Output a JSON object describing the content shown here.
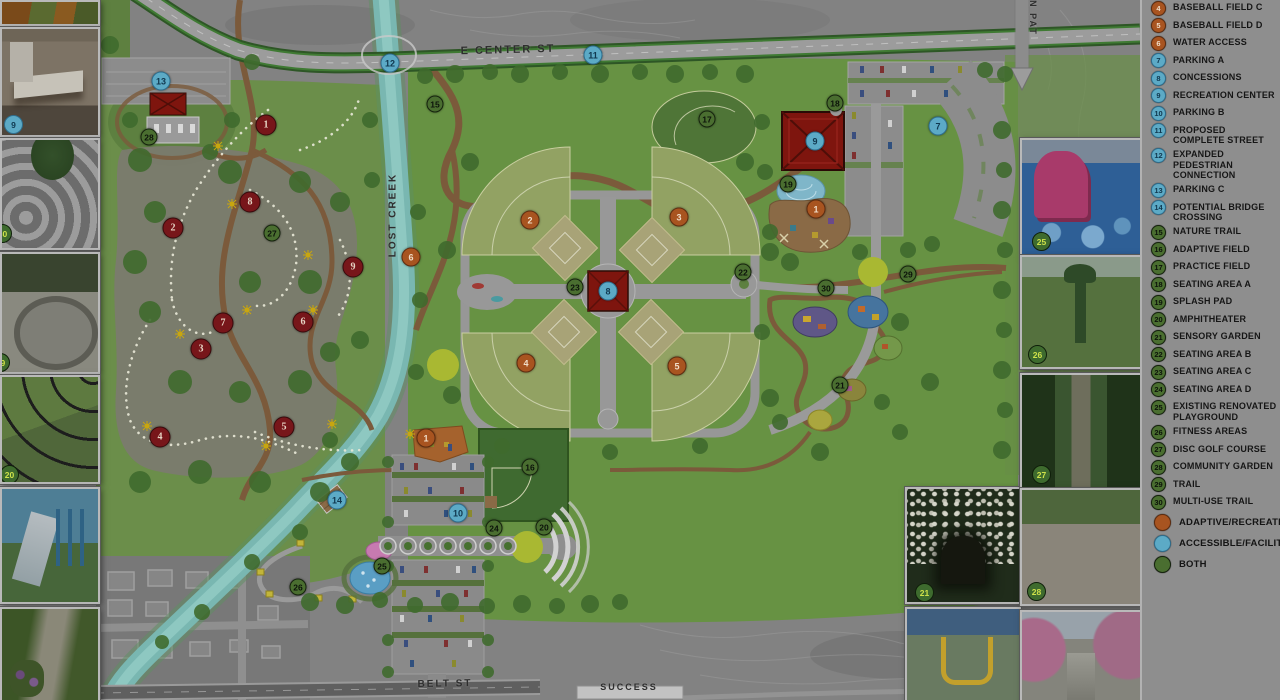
{
  "title": "park-master-plan",
  "map": {
    "street_labels": [
      {
        "text": "E CENTER ST",
        "x": 508,
        "y": 50,
        "rot": -1.5,
        "size": 11
      },
      {
        "text": "LOST CREEK",
        "x": 393,
        "y": 215,
        "rot": -90,
        "size": 10
      },
      {
        "text": "N PAT",
        "x": 1033,
        "y": 18,
        "rot": 90,
        "size": 9
      },
      {
        "text": "BELT ST",
        "x": 445,
        "y": 684,
        "rot": -1,
        "size": 10
      },
      {
        "text": "SUCCESS",
        "x": 629,
        "y": 687,
        "rot": 0,
        "size": 9
      }
    ],
    "markers": [
      {
        "n": "1",
        "t": "o",
        "x": 816,
        "y": 209
      },
      {
        "n": "1",
        "t": "o",
        "x": 426,
        "y": 438
      },
      {
        "n": "2",
        "t": "o",
        "x": 530,
        "y": 220
      },
      {
        "n": "3",
        "t": "o",
        "x": 679,
        "y": 217
      },
      {
        "n": "4",
        "t": "o",
        "x": 526,
        "y": 363
      },
      {
        "n": "5",
        "t": "o",
        "x": 677,
        "y": 366
      },
      {
        "n": "6",
        "t": "o",
        "x": 411,
        "y": 257
      },
      {
        "n": "7",
        "t": "b",
        "x": 938,
        "y": 126
      },
      {
        "n": "8",
        "t": "b",
        "x": 608,
        "y": 291
      },
      {
        "n": "9",
        "t": "b",
        "x": 815,
        "y": 141
      },
      {
        "n": "10",
        "t": "b",
        "x": 458,
        "y": 513
      },
      {
        "n": "11",
        "t": "b",
        "x": 593,
        "y": 55
      },
      {
        "n": "12",
        "t": "b",
        "x": 390,
        "y": 63
      },
      {
        "n": "13",
        "t": "b",
        "x": 161,
        "y": 81
      },
      {
        "n": "14",
        "t": "b",
        "x": 337,
        "y": 500
      },
      {
        "n": "15",
        "t": "g",
        "x": 435,
        "y": 104
      },
      {
        "n": "16",
        "t": "g",
        "x": 530,
        "y": 467
      },
      {
        "n": "17",
        "t": "g",
        "x": 707,
        "y": 119
      },
      {
        "n": "18",
        "t": "g",
        "x": 835,
        "y": 103
      },
      {
        "n": "19",
        "t": "g",
        "x": 788,
        "y": 184
      },
      {
        "n": "20",
        "t": "g",
        "x": 544,
        "y": 527
      },
      {
        "n": "21",
        "t": "g",
        "x": 840,
        "y": 385
      },
      {
        "n": "22",
        "t": "g",
        "x": 743,
        "y": 272
      },
      {
        "n": "23",
        "t": "g",
        "x": 575,
        "y": 287
      },
      {
        "n": "24",
        "t": "g",
        "x": 494,
        "y": 528
      },
      {
        "n": "25",
        "t": "g",
        "x": 382,
        "y": 566
      },
      {
        "n": "26",
        "t": "g",
        "x": 298,
        "y": 587
      },
      {
        "n": "27",
        "t": "g",
        "x": 272,
        "y": 233
      },
      {
        "n": "28",
        "t": "g",
        "x": 149,
        "y": 137
      },
      {
        "n": "29",
        "t": "g",
        "x": 908,
        "y": 274
      },
      {
        "n": "30",
        "t": "g",
        "x": 826,
        "y": 288
      },
      {
        "n": "1",
        "t": "h",
        "x": 266,
        "y": 125
      },
      {
        "n": "2",
        "t": "h",
        "x": 173,
        "y": 228
      },
      {
        "n": "3",
        "t": "h",
        "x": 201,
        "y": 349
      },
      {
        "n": "4",
        "t": "h",
        "x": 160,
        "y": 437
      },
      {
        "n": "5",
        "t": "h",
        "x": 284,
        "y": 427
      },
      {
        "n": "6",
        "t": "h",
        "x": 303,
        "y": 322
      },
      {
        "n": "7",
        "t": "h",
        "x": 223,
        "y": 323
      },
      {
        "n": "8",
        "t": "h",
        "x": 250,
        "y": 202
      },
      {
        "n": "9",
        "t": "h",
        "x": 353,
        "y": 267
      }
    ]
  },
  "photos": [
    {
      "kind": "play-closeup",
      "name": "photo-playground-closeup",
      "x": 0,
      "y": 0,
      "w": 96,
      "h": 22
    },
    {
      "kind": "changing-room",
      "name": "photo-adult-changing-room",
      "x": 0,
      "y": 27,
      "w": 96,
      "h": 106,
      "badge": {
        "n": "9",
        "c": "blue",
        "bx": 2,
        "by": 86
      }
    },
    {
      "kind": "curvy-path",
      "name": "photo-curved-walkway",
      "x": 0,
      "y": 138,
      "w": 96,
      "h": 108,
      "badge": {
        "n": "30",
        "c": "green",
        "bx": -9,
        "by": 84
      }
    },
    {
      "kind": "fountain",
      "name": "photo-splash-fountain",
      "x": 0,
      "y": 252,
      "w": 96,
      "h": 118,
      "badge": {
        "n": "19",
        "c": "green",
        "bx": -11,
        "by": 99
      }
    },
    {
      "kind": "amphitheater",
      "name": "photo-amphitheater",
      "x": 0,
      "y": 375,
      "w": 96,
      "h": 105,
      "badge": {
        "n": "20",
        "c": "green",
        "bx": -2,
        "by": 88
      }
    },
    {
      "kind": "slide",
      "name": "photo-playground-slide",
      "x": 0,
      "y": 487,
      "w": 96,
      "h": 113
    },
    {
      "kind": "garden-path",
      "name": "photo-garden-path",
      "x": 0,
      "y": 607,
      "w": 96,
      "h": 93
    },
    {
      "kind": "arbor",
      "name": "photo-sensory-garden-arbor",
      "x": 905,
      "y": 487,
      "w": 112,
      "h": 113,
      "badge": {
        "n": "21",
        "c": "green",
        "bx": 8,
        "by": 94
      }
    },
    {
      "kind": "swing",
      "name": "photo-adaptive-swing",
      "x": 905,
      "y": 607,
      "w": 112,
      "h": 93
    },
    {
      "kind": "playground25",
      "name": "photo-renovated-playground",
      "x": 1020,
      "y": 138,
      "w": 118,
      "h": 114,
      "badge": {
        "n": "25",
        "c": "green",
        "bx": 10,
        "by": 92
      }
    },
    {
      "kind": "fitness",
      "name": "photo-fitness-areas",
      "x": 1020,
      "y": 255,
      "w": 118,
      "h": 110,
      "badge": {
        "n": "26",
        "c": "green",
        "bx": 6,
        "by": 88
      }
    },
    {
      "kind": "discgolf",
      "name": "photo-disc-golf",
      "x": 1020,
      "y": 373,
      "w": 118,
      "h": 112,
      "badge": {
        "n": "27",
        "c": "green",
        "bx": 10,
        "by": 90
      }
    },
    {
      "kind": "garden-beds",
      "name": "photo-community-garden",
      "x": 1020,
      "y": 488,
      "w": 118,
      "h": 114,
      "badge": {
        "n": "28",
        "c": "green",
        "bx": 5,
        "by": 92
      }
    },
    {
      "kind": "blossoms",
      "name": "photo-blossom-trail",
      "x": 1020,
      "y": 610,
      "w": 118,
      "h": 90
    }
  ],
  "legend": {
    "items": [
      {
        "n": "3",
        "color": "orange",
        "label": "BASEBALL FIELD B",
        "partial": true
      },
      {
        "n": "4",
        "color": "orange",
        "label": "BASEBALL FIELD C"
      },
      {
        "n": "5",
        "color": "orange",
        "label": "BASEBALL FIELD D"
      },
      {
        "n": "6",
        "color": "orange",
        "label": "WATER ACCESS"
      },
      {
        "n": "7",
        "color": "blue",
        "label": "PARKING A"
      },
      {
        "n": "8",
        "color": "blue",
        "label": "CONCESSIONS"
      },
      {
        "n": "9",
        "color": "blue",
        "label": "RECREATION CENTER"
      },
      {
        "n": "10",
        "color": "blue",
        "label": "PARKING B"
      },
      {
        "n": "11",
        "color": "blue",
        "label": "PROPOSED COMPLETE STREET"
      },
      {
        "n": "12",
        "color": "blue",
        "label": "EXPANDED PEDESTRIAN CONNECTION"
      },
      {
        "n": "13",
        "color": "blue",
        "label": "PARKING C"
      },
      {
        "n": "14",
        "color": "blue",
        "label": "POTENTIAL BRIDGE CROSSING"
      },
      {
        "n": "15",
        "color": "green",
        "label": "NATURE TRAIL"
      },
      {
        "n": "16",
        "color": "green",
        "label": "ADAPTIVE  FIELD"
      },
      {
        "n": "17",
        "color": "green",
        "label": "PRACTICE FIELD"
      },
      {
        "n": "18",
        "color": "green",
        "label": "SEATING AREA A"
      },
      {
        "n": "19",
        "color": "green",
        "label": "SPLASH PAD"
      },
      {
        "n": "20",
        "color": "green",
        "label": "AMPHITHEATER"
      },
      {
        "n": "21",
        "color": "green",
        "label": "SENSORY GARDEN"
      },
      {
        "n": "22",
        "color": "green",
        "label": "SEATING AREA B"
      },
      {
        "n": "23",
        "color": "green",
        "label": "SEATING AREA C"
      },
      {
        "n": "24",
        "color": "green",
        "label": "SEATING AREA D"
      },
      {
        "n": "25",
        "color": "green",
        "label": "EXISTING RENOVATED PLAYGROUND"
      },
      {
        "n": "26",
        "color": "green",
        "label": "FITNESS AREAS"
      },
      {
        "n": "27",
        "color": "green",
        "label": "DISC GOLF COURSE"
      },
      {
        "n": "28",
        "color": "green",
        "label": "COMMUNITY GARDEN"
      },
      {
        "n": "29",
        "color": "green",
        "label": "TRAIL"
      },
      {
        "n": "30",
        "color": "green",
        "label": "MULTI-USE TRAIL"
      }
    ],
    "key": [
      {
        "color": "orange",
        "label": "ADAPTIVE/RECREATIONAL"
      },
      {
        "color": "blue",
        "label": "ACCESSIBLE/FACILITY"
      },
      {
        "color": "green",
        "label": "BOTH"
      }
    ],
    "note": {
      "title": "CONCEPTUAL NOTE:",
      "body": "THE INFORMATION CONTAINED HEREIN IS FOR DISCUSSION PURPOSES ONLY, AND IS SUBJECT TO ADDITIONAL INPUT AND REVIEW"
    },
    "logo": {
      "name": "JONESBORO",
      "sub": "ARKANSAS"
    }
  }
}
